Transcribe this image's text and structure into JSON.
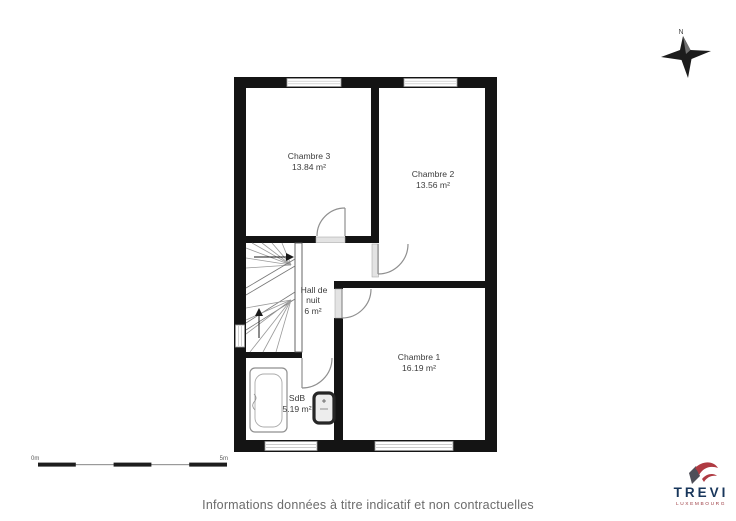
{
  "floor_plan": {
    "rooms": [
      {
        "name": "Chambre 3",
        "area": "13.84 m²"
      },
      {
        "name": "Chambre 2",
        "area": "13.56 m²"
      },
      {
        "name": "Chambre 1",
        "area": "16.19 m²"
      },
      {
        "line1": "Hall de",
        "line2": "nuit",
        "area": "6 m²"
      },
      {
        "name": "SdB",
        "area": "5.19 m²"
      }
    ],
    "wall_color": "#141414",
    "door_line_color": "#8f8f8f",
    "window_fill": "#ffffff"
  },
  "compass": {
    "label": "N"
  },
  "scale_bar": {
    "start_label": "0m",
    "end_label": "5m"
  },
  "logo": {
    "brand": "TREVI",
    "subtitle": "LUXEMBOURG",
    "brand_color": "#18365b",
    "accent_color": "#af3a42"
  },
  "footer": {
    "disclaimer": "Informations données à titre indicatif et non contractuelles"
  }
}
